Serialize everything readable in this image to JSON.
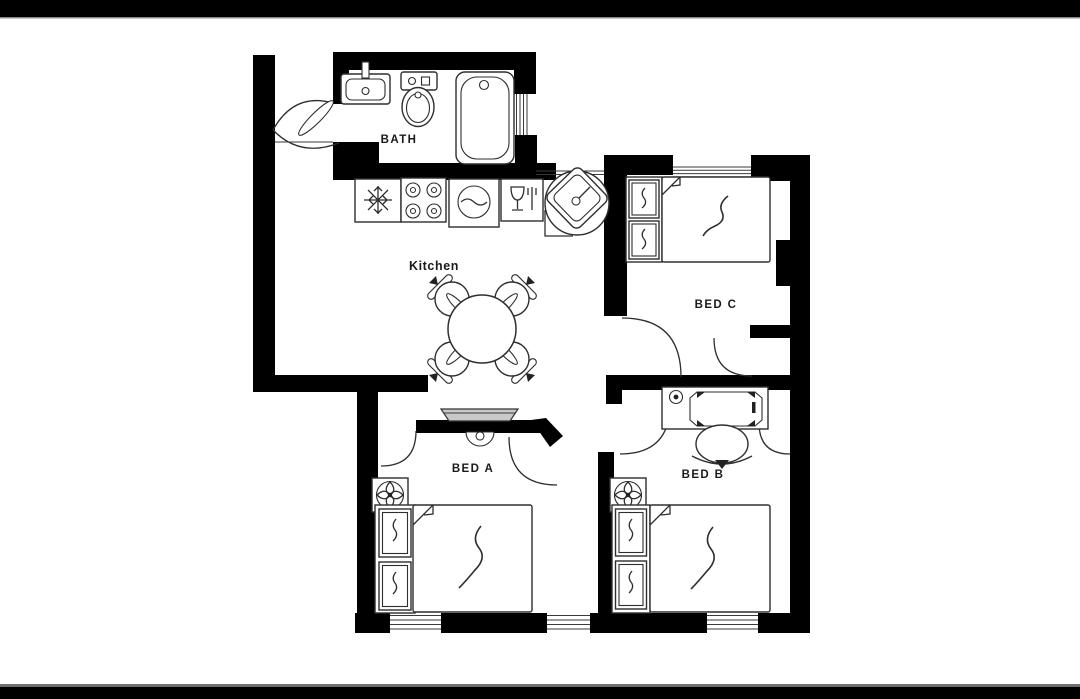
{
  "scene": {
    "type": "apartment-floor-plan",
    "background": "#ffffff"
  },
  "letterbox": {
    "top_bar": true,
    "bottom_bar": true,
    "color": "#000000",
    "edge_color": "#6e6e6e"
  },
  "colors": {
    "wall": "#000000",
    "line": "#2e2e2e",
    "fixture": "#ffffff",
    "tv": "#c9c9c9",
    "label": "#1a1a1a",
    "page_bg": "#ffffff",
    "letterbox": "#000000",
    "letterbox_edge": "#6e6e6e"
  },
  "rooms": {
    "bath": {
      "label": "BATH"
    },
    "kitchen": {
      "label": "Kitchen"
    },
    "bed_a": {
      "label": "BED A"
    },
    "bed_b": {
      "label": "BED B"
    },
    "bed_c": {
      "label": "BED C"
    }
  },
  "icons": {
    "bath": [
      "bathroom-sink-icon",
      "toilet-icon",
      "bathtub-icon",
      "door-swing-icon",
      "window-icon"
    ],
    "kitchen": [
      "freezer-snowflake-icon",
      "stove-burners-icon",
      "washing-machine-icon",
      "wine-glass-fork-icon",
      "corner-sink-icon",
      "dining-table-icon",
      "dining-chair-icon",
      "wall-tv-icon"
    ],
    "bed_a": [
      "ceiling-fan-icon",
      "double-bed-icon",
      "pillow-icon",
      "door-swing-icon",
      "window-icon"
    ],
    "bed_b": [
      "desk-icon",
      "desk-lamp-icon",
      "laptop-icon",
      "desk-chair-icon",
      "ceiling-fan-icon",
      "double-bed-icon",
      "pillow-icon",
      "door-swing-icon",
      "window-icon"
    ],
    "bed_c": [
      "double-bed-icon",
      "pillow-icon",
      "door-swing-icon",
      "closet-door-icon",
      "window-icon"
    ]
  },
  "counts": {
    "bedrooms": 3,
    "bathrooms": 1,
    "dining_chairs": 4,
    "windows": 5
  }
}
